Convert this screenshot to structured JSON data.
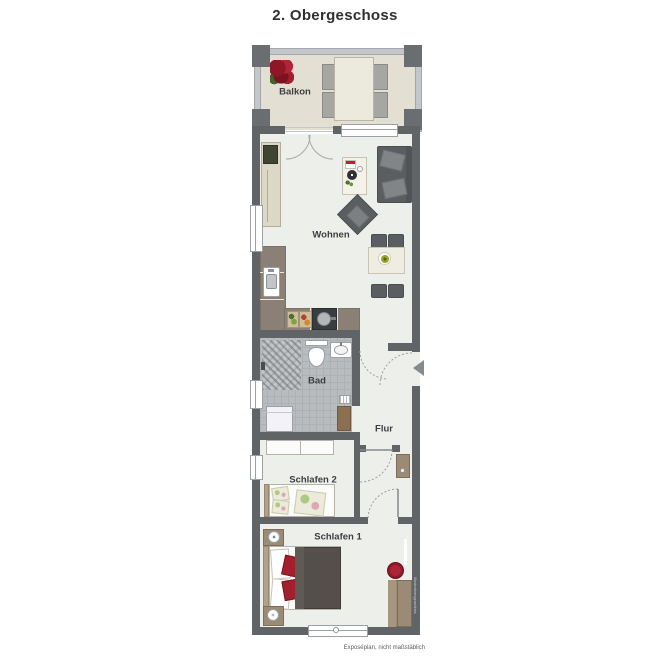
{
  "title": "2. Obergeschoss",
  "rooms": {
    "balkon": {
      "label": "Balkon"
    },
    "wohnen": {
      "label": "Wohnen"
    },
    "bad": {
      "label": "Bad"
    },
    "flur": {
      "label": "Flur"
    },
    "schlafen2": {
      "label": "Schlafen 2"
    },
    "schlafen1": {
      "label": "Schlafen 1"
    }
  },
  "footer": {
    "caption": "Exposéplan, nicht maßstäblich"
  },
  "watermark": {
    "vertical_text": "Illustrationsgrundriss"
  },
  "icons": {
    "entry_arrow": "left-pointing-triangle-apartment-entrance",
    "flower_pot": "red-flower-on-balcony"
  },
  "furniture": {
    "balkon": [
      "flower-pot",
      "outdoor-table",
      "four-chairs"
    ],
    "wohnen": [
      "tv-sideboard",
      "sofa",
      "armchair",
      "coffee-table-with-decor",
      "dining-table-with-plate",
      "four-dining-chairs",
      "l-shaped-kitchen-counter",
      "kitchen-sink",
      "stove-with-pot",
      "cutting-boards"
    ],
    "bad": [
      "shower",
      "toilet",
      "washbasin",
      "washing-machine",
      "heater",
      "bathroom-door"
    ],
    "flur": [
      "wall-cabinet"
    ],
    "schlafen2": [
      "wardrobe",
      "single-bed-with-pillows-and-blanket"
    ],
    "schlafen1": [
      "double-bed-with-red-pillows",
      "two-nightstands-with-lamps",
      "red-chair",
      "wardrobe",
      "wall-shelf"
    ]
  },
  "colors": {
    "wall": "#616467",
    "floor": "#edefeb",
    "balcony_floor": "#e3e0d3",
    "bathroom_floor": "#b9bcbe",
    "kitchen_counter": "#8b8076",
    "wood": "#9c8b74",
    "dark_furniture": "#5b5e60",
    "accent_red": "#a21f2e",
    "label_text": "#3c3e41"
  }
}
